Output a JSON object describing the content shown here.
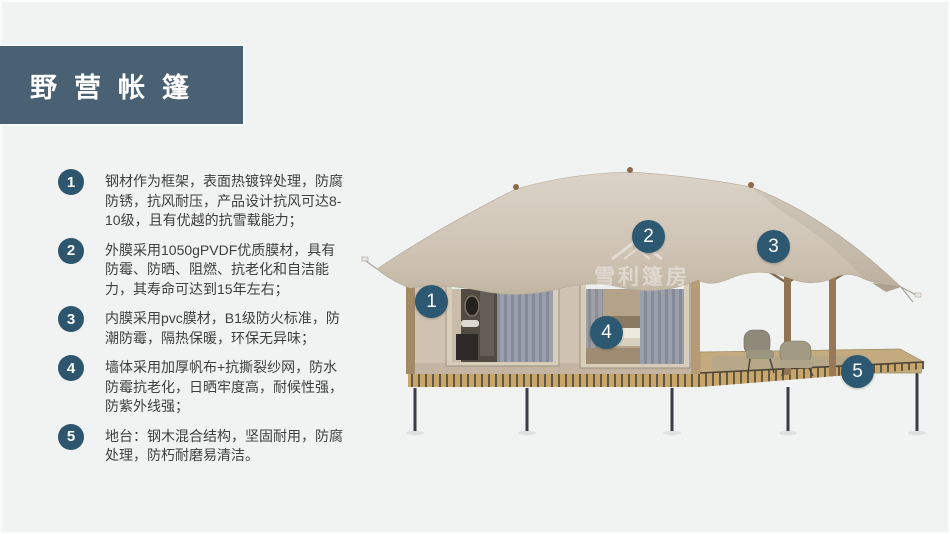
{
  "title": {
    "text": "野营帐篷"
  },
  "features": [
    {
      "num": "1",
      "text": "钢材作为框架，表面热镀锌处理，防腐防锈，抗风耐压，产品设计抗风可达8-10级，且有优越的抗雪载能力；"
    },
    {
      "num": "2",
      "text": "外膜采用1050gPVDF优质膜材，具有防霉、防晒、阻燃、抗老化和自洁能力，其寿命可达到15年左右；"
    },
    {
      "num": "3",
      "text": "内膜采用pvc膜材，B1级防火标准，防潮防霉，隔热保暖，环保无异味；"
    },
    {
      "num": "4",
      "text": "墙体采用加厚帆布+抗撕裂纱网，防水防霉抗老化，日晒牢度高，耐候性强，防紫外线强；"
    },
    {
      "num": "5",
      "text": "地台：钢木混合结构，坚固耐用，防腐处理，防朽耐磨易清洁。"
    }
  ],
  "markers": [
    {
      "num": "1"
    },
    {
      "num": "2"
    },
    {
      "num": "3"
    },
    {
      "num": "4"
    },
    {
      "num": "5"
    }
  ],
  "watermark": {
    "text": "雪利篷房"
  },
  "colors": {
    "title_bar": "#4a6173",
    "badge": "#2d566e",
    "marker": "#2c5971",
    "canopy": "#cfc5b8",
    "wall": "#cfc2b0",
    "deck_band": "#c8a66a",
    "background": "#f1f2f2",
    "text": "#3f3f3f"
  }
}
